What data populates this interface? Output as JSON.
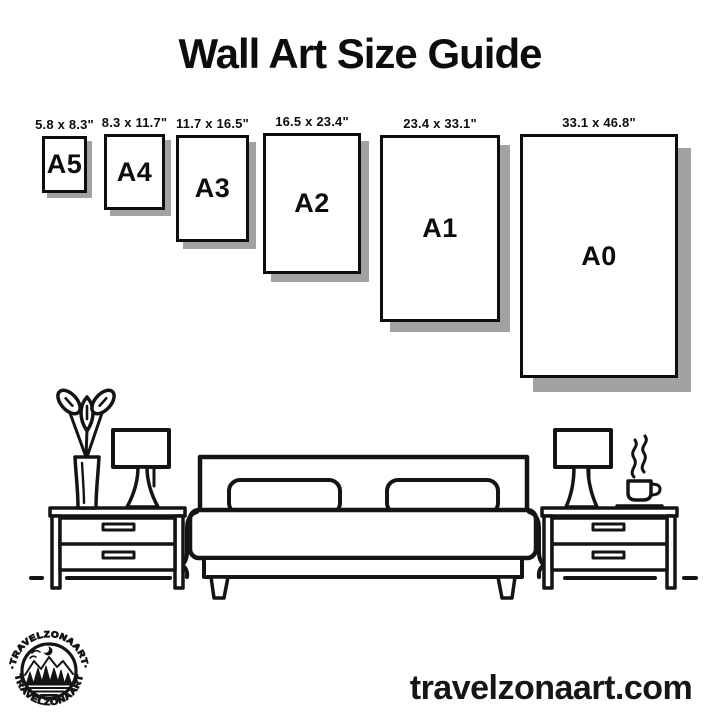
{
  "title": "Wall Art Size Guide",
  "sizes": [
    {
      "code": "A5",
      "dimensions": "5.8 x 8.3\""
    },
    {
      "code": "A4",
      "dimensions": "8.3 x 11.7\""
    },
    {
      "code": "A3",
      "dimensions": "11.7 x 16.5\""
    },
    {
      "code": "A2",
      "dimensions": "16.5 x 23.4\""
    },
    {
      "code": "A1",
      "dimensions": "23.4 x 33.1\""
    },
    {
      "code": "A0",
      "dimensions": "33.1 x 46.8\""
    }
  ],
  "logo": {
    "brand": "TRAVELZONAART",
    "arc_top": "·TRAVELZONAART·",
    "arc_bottom": "TRAVELZONAART"
  },
  "footer": {
    "website": "travelzonaart.com"
  },
  "illustration": {
    "icons": [
      "potted-plant-icon",
      "table-lamp-icon",
      "nightstand-icon",
      "double-bed-icon",
      "nightstand-icon",
      "table-lamp-icon",
      "coffee-cup-icon"
    ]
  },
  "colors": {
    "ink": "#141414",
    "shadow": "#a2a2a2",
    "background": "#ffffff"
  }
}
